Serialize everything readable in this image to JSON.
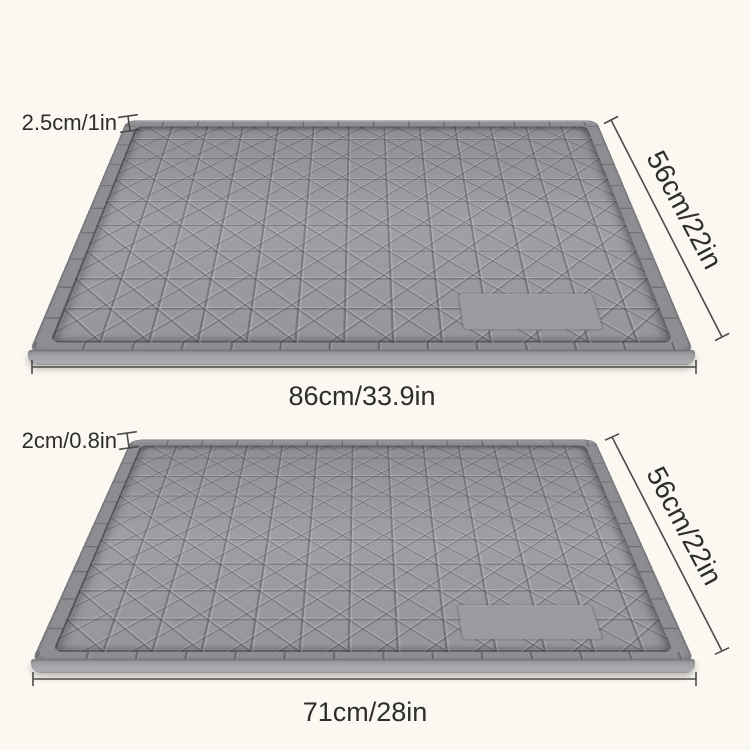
{
  "colors": {
    "background": "#faf8f1",
    "mat_surface": "#9b9a9f",
    "mat_rim": "#8e8d92",
    "mat_groove": "#85848a",
    "dimension_line": "#4b4b4b",
    "text": "#2d2d2d"
  },
  "mats": [
    {
      "id": "large",
      "height_label": "2.5cm/1in",
      "width_label": "86cm/33.9in",
      "depth_label": "56cm/22in"
    },
    {
      "id": "small",
      "height_label": "2cm/0.8in",
      "width_label": "71cm/28in",
      "depth_label": "56cm/22in"
    }
  ]
}
